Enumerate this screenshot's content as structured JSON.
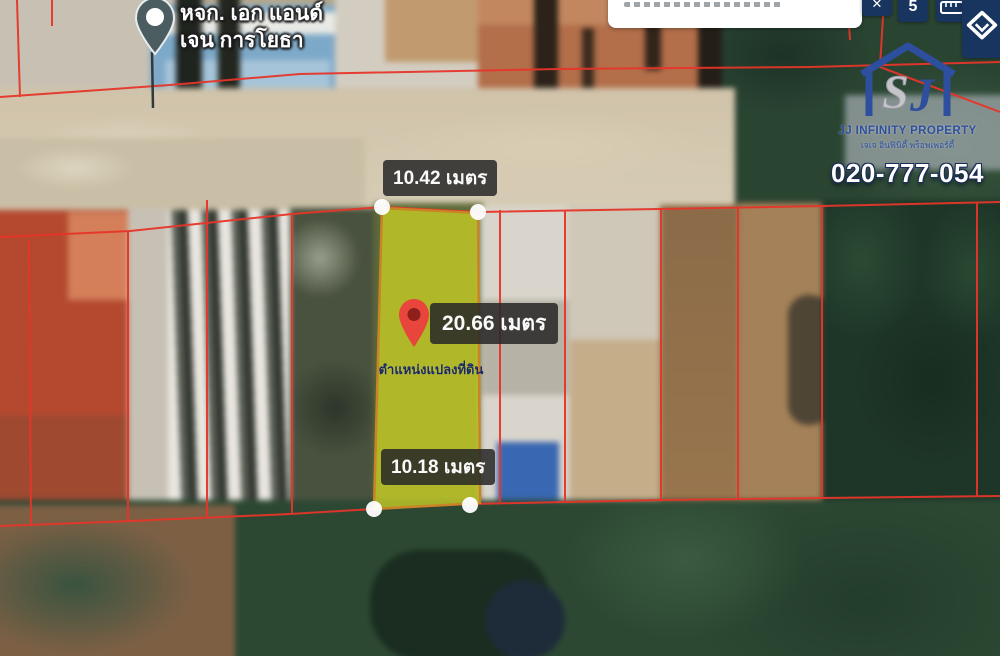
{
  "toolbar": {
    "icons": {
      "close": "✕",
      "badge": "5"
    }
  },
  "map": {
    "business_pin": {
      "line1": "หจก. เอก แอนด์",
      "line2": "เจน การโยธา"
    },
    "parcel": {
      "top_width": "10.42 เมตร",
      "side_length": "20.66 เมตร",
      "bottom_width": "10.18 เมตร",
      "caption": "ตำแหน่งแปลงที่ดิน"
    }
  },
  "branding": {
    "company": "JJ INFINITY PROPERTY",
    "company_thai": "เจเจ อินฟินิตี้ พร็อพเพอร์ตี้",
    "phone": "020-777-054",
    "logo_glyphs": {
      "gray": "S",
      "blue": "J"
    }
  },
  "colors": {
    "boundary_red": "#e8392b",
    "parcel_fill": "#b9bf2f",
    "parcel_border": "#c98426",
    "label_bg": "#2b2b2b",
    "brand_blue": "#2d4f9e",
    "toolbar_navy": "#17355e"
  }
}
